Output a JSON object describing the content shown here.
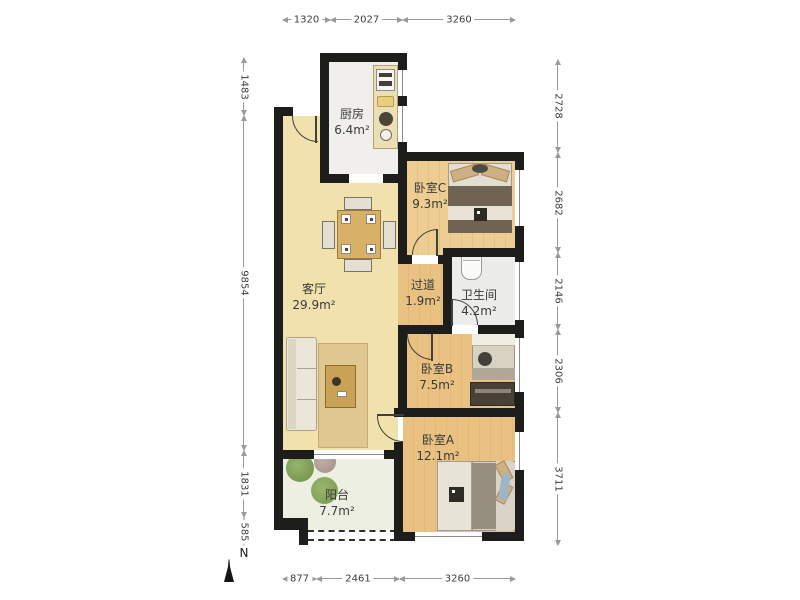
{
  "compass": {
    "label": "N"
  },
  "dims": {
    "top": [
      "1320",
      "2027",
      "3260"
    ],
    "left": [
      "1483",
      "9854",
      "1831",
      "585"
    ],
    "right": [
      "2728",
      "2682",
      "2146",
      "2306",
      "3711"
    ],
    "bottom": [
      "877",
      "2461",
      "3260"
    ]
  },
  "rooms": {
    "kitchen": {
      "name": "厨房",
      "area": "6.4m²"
    },
    "bedroomC": {
      "name": "卧室C",
      "area": "9.3m²"
    },
    "living": {
      "name": "客厅",
      "area": "29.9m²"
    },
    "hallway": {
      "name": "过道",
      "area": "1.9m²"
    },
    "bathroom": {
      "name": "卫生间",
      "area": "4.2m²"
    },
    "bedroomB": {
      "name": "卧室B",
      "area": "7.5m²"
    },
    "bedroomA": {
      "name": "卧室A",
      "area": "12.1m²"
    },
    "balcony": {
      "name": "阳台",
      "area": "7.7m²"
    }
  },
  "colors": {
    "wall": "#1d1d1b",
    "wood_floor": "#e9c283",
    "living_floor": "#f1e1ad",
    "kitchen_floor": "#f0efeb",
    "bath_floor": "#ececea",
    "balcony_floor": "#edefe2",
    "dim_line": "#9a9a9a"
  }
}
